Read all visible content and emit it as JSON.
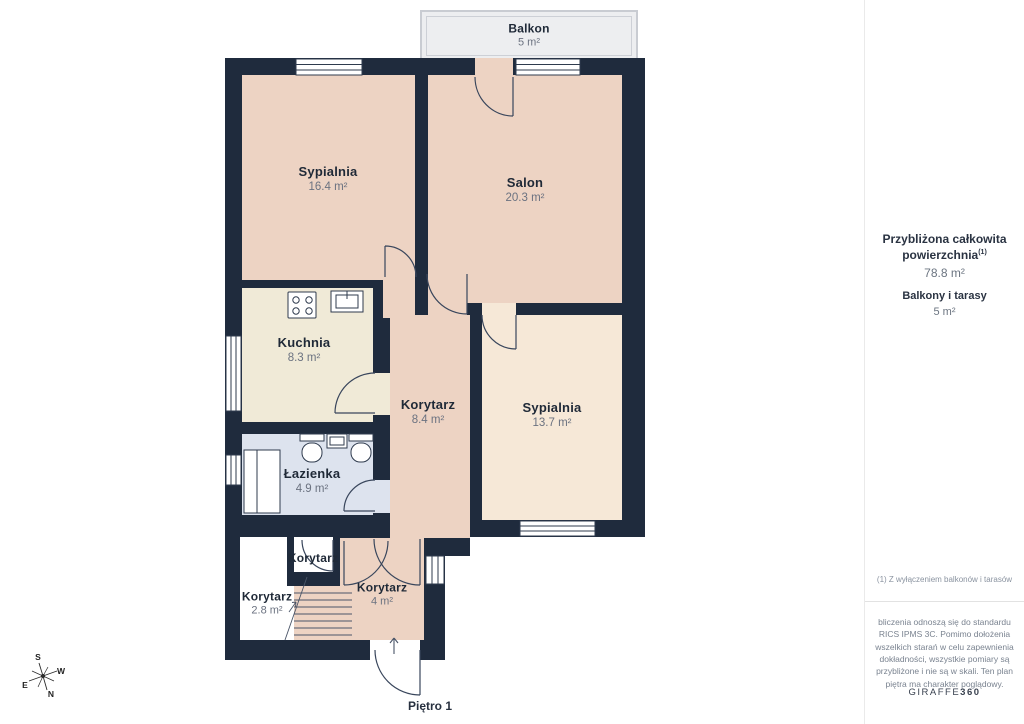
{
  "floor_label": "Piętro 1",
  "balcony": {
    "name": "Balkon",
    "area": "5 m²"
  },
  "rooms": [
    {
      "id": "sypialnia-1",
      "name": "Sypialnia",
      "area": "16.4 m²"
    },
    {
      "id": "salon",
      "name": "Salon",
      "area": "20.3 m²"
    },
    {
      "id": "kuchnia",
      "name": "Kuchnia",
      "area": "8.3 m²"
    },
    {
      "id": "korytarz-main",
      "name": "Korytarz",
      "area": "8.4 m²"
    },
    {
      "id": "sypialnia-2",
      "name": "Sypialnia",
      "area": "13.7 m²"
    },
    {
      "id": "lazienka",
      "name": "Łazienka",
      "area": "4.9 m²"
    },
    {
      "id": "korytarz-small",
      "name": "Korytarz",
      "area": ""
    },
    {
      "id": "korytarz-28",
      "name": "Korytarz",
      "area": "2.8 m²"
    },
    {
      "id": "korytarz-4",
      "name": "Korytarz",
      "area": "4 m²"
    }
  ],
  "sidebar": {
    "total_label": "Przybliżona całkowita powierzchnia",
    "total_sup": "(1)",
    "total_value": "78.8 m²",
    "balconies_label": "Balkony i tarasy",
    "balconies_value": "5 m²",
    "footnote": "(1) Z wyłączeniem balkonów i tarasów",
    "disclaimer": "bliczenia odnoszą się do standardu RICS IPMS 3C. Pomimo dołożenia wszelkich starań w celu zapewnienia dokładności, wszystkie pomiary są przybliżone i nie są w skali. Ten plan piętra ma charakter poglądowy.",
    "brand_name": "GIRAFFE",
    "brand_suffix": "360"
  },
  "compass": {
    "n": "N",
    "s": "S",
    "e": "E",
    "w": "W"
  },
  "icons": {
    "stove": "stove-icon",
    "kitchen_sink": "sink-icon",
    "toilet": "toilet-icon",
    "bathroom_sink": "sink-icon",
    "shower": "shower-icon",
    "stairs": "stairs-icon",
    "entry_arrow": "entry-arrow-icon",
    "compass": "compass-rose-icon"
  },
  "colors": {
    "wall": "#1F2B3D",
    "room_pink": "#EDD3C3",
    "room_cream": "#F0EAD7",
    "room_light": "#F6E8D7",
    "room_blue": "#DDE3EE",
    "balcony_bg": "#EDEEF0",
    "outline": "#39465C",
    "text_dark": "#1F2937",
    "text_gray": "#6B7280"
  }
}
